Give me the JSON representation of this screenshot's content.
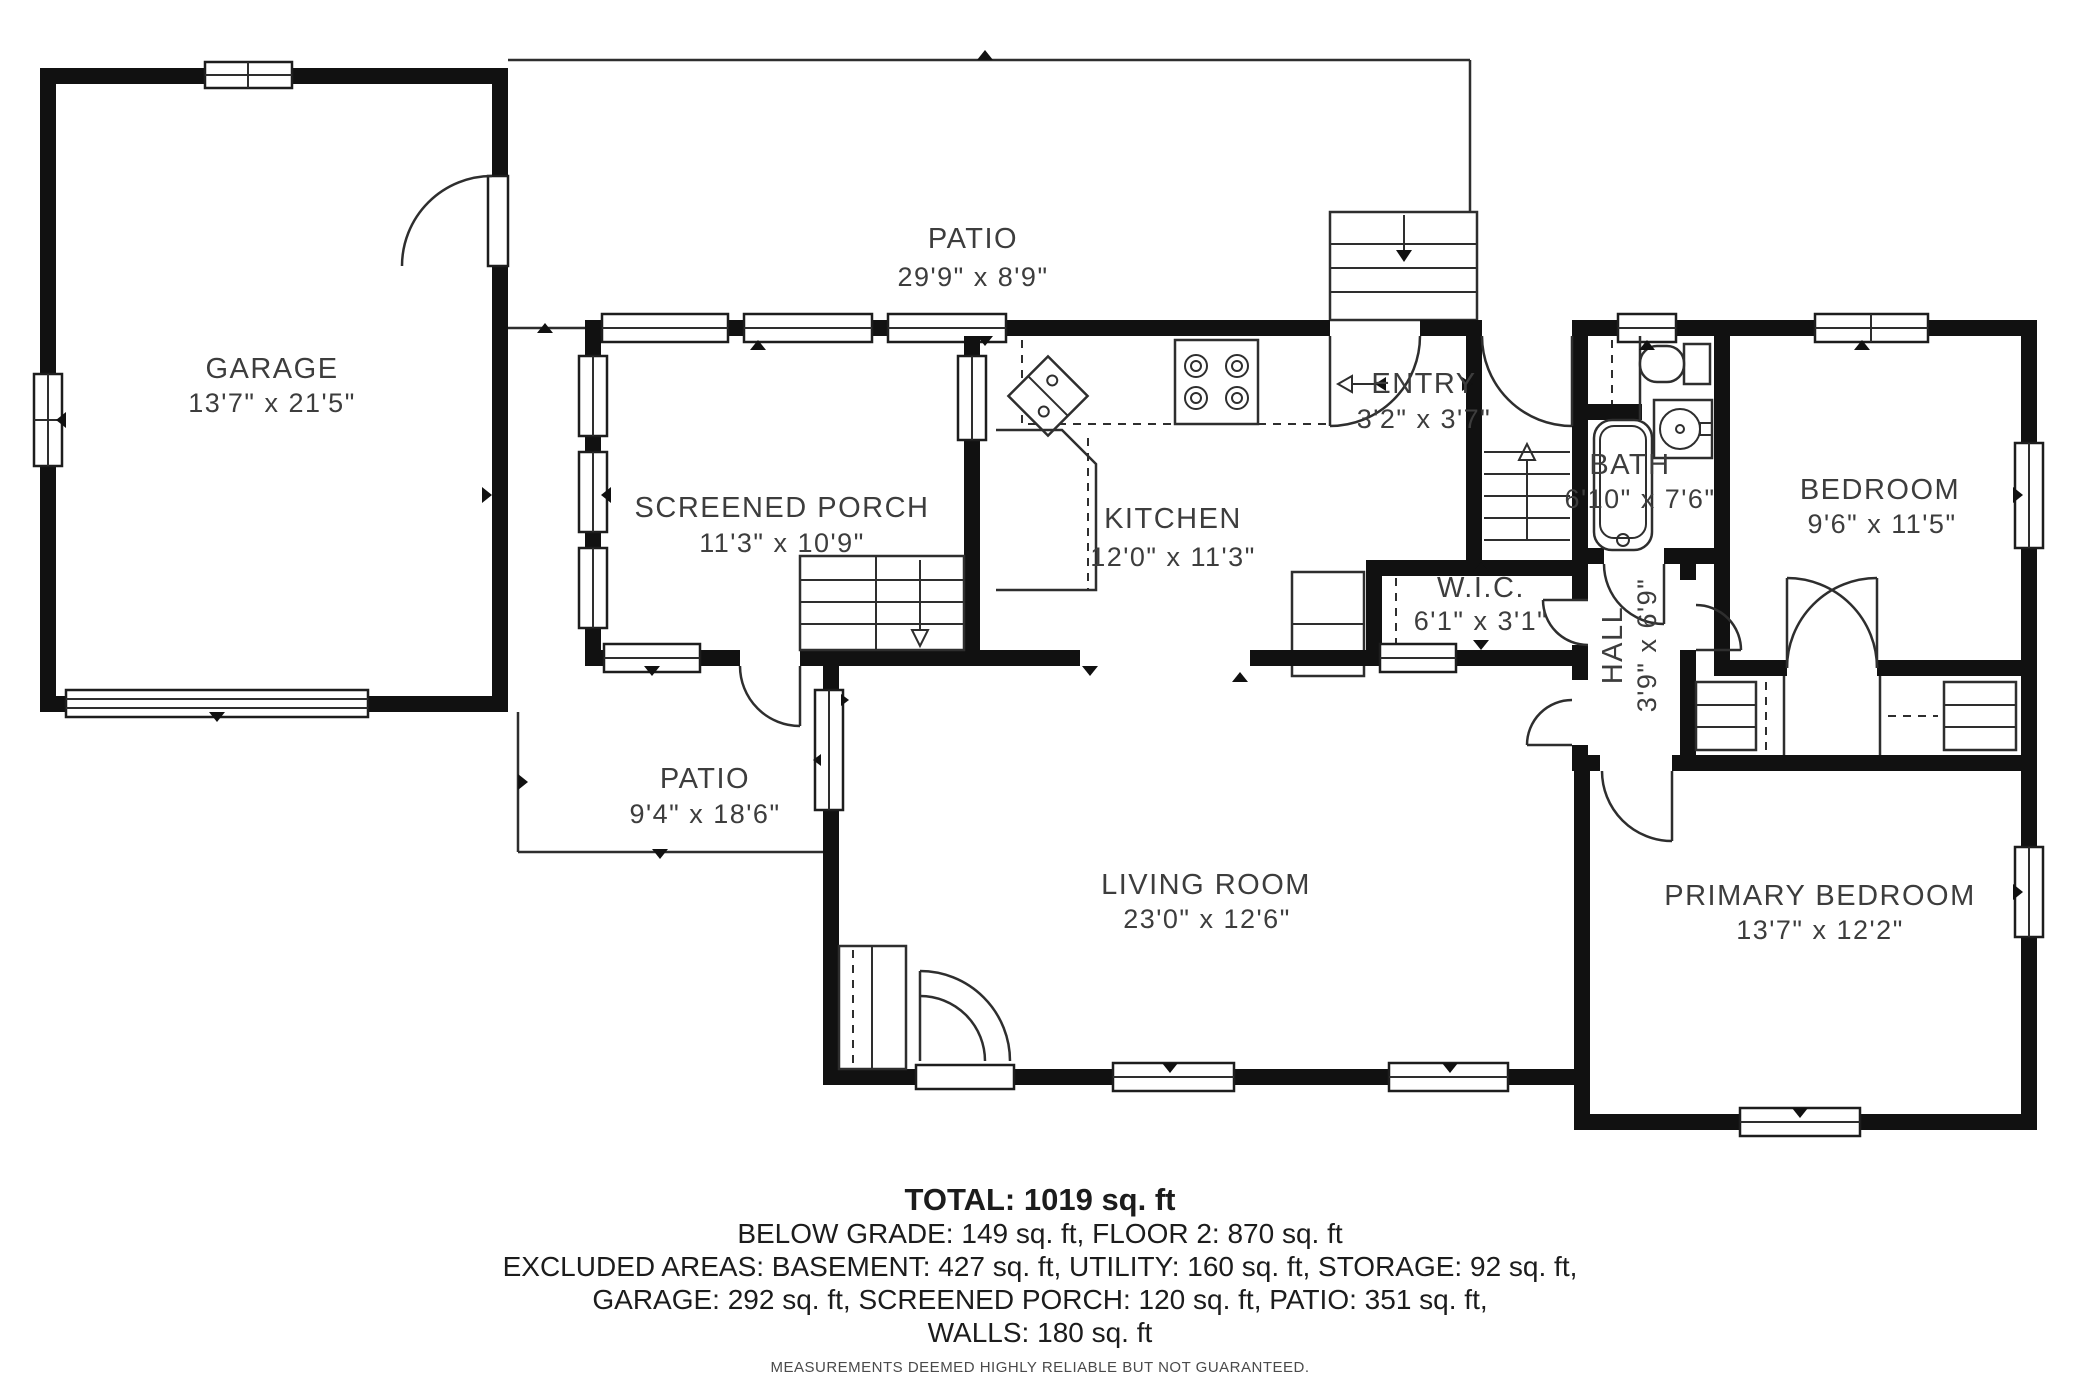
{
  "rooms": [
    {
      "name": "GARAGE",
      "dims": "13'7\" x 21'5\""
    },
    {
      "name": "PATIO",
      "dims": "29'9\" x 8'9\""
    },
    {
      "name": "SCREENED PORCH",
      "dims": "11'3\" x 10'9\""
    },
    {
      "name": "KITCHEN",
      "dims": "12'0\" x 11'3\""
    },
    {
      "name": "ENTRY",
      "dims": "3'2\" x 3'7\""
    },
    {
      "name": "BATH",
      "dims": "6'10\" x 7'6\""
    },
    {
      "name": "BEDROOM",
      "dims": "9'6\" x 11'5\""
    },
    {
      "name": "W.I.C.",
      "dims": "6'1\" x 3'1\""
    },
    {
      "name": "HALL",
      "dims": "3'9\" x 6'9\""
    },
    {
      "name": "PATIO",
      "dims": "9'4\" x 18'6\""
    },
    {
      "name": "LIVING ROOM",
      "dims": "23'0\" x 12'6\""
    },
    {
      "name": "PRIMARY BEDROOM",
      "dims": "13'7\" x 12'2\""
    }
  ],
  "summary": {
    "total": "TOTAL: 1019 sq. ft",
    "line1": "BELOW GRADE: 149 sq. ft, FLOOR 2: 870 sq. ft",
    "line2": "EXCLUDED AREAS: BASEMENT: 427 sq. ft, UTILITY: 160 sq. ft, STORAGE: 92 sq. ft,",
    "line3": "GARAGE: 292 sq. ft, SCREENED PORCH: 120 sq. ft, PATIO: 351 sq. ft,",
    "line4": "WALLS: 180 sq. ft",
    "disclaimer": "MEASUREMENTS DEEMED HIGHLY RELIABLE BUT NOT GUARANTEED."
  },
  "colors": {
    "wall": "#111111",
    "line": "#2e2e2e",
    "label": "#3d3d3d"
  }
}
